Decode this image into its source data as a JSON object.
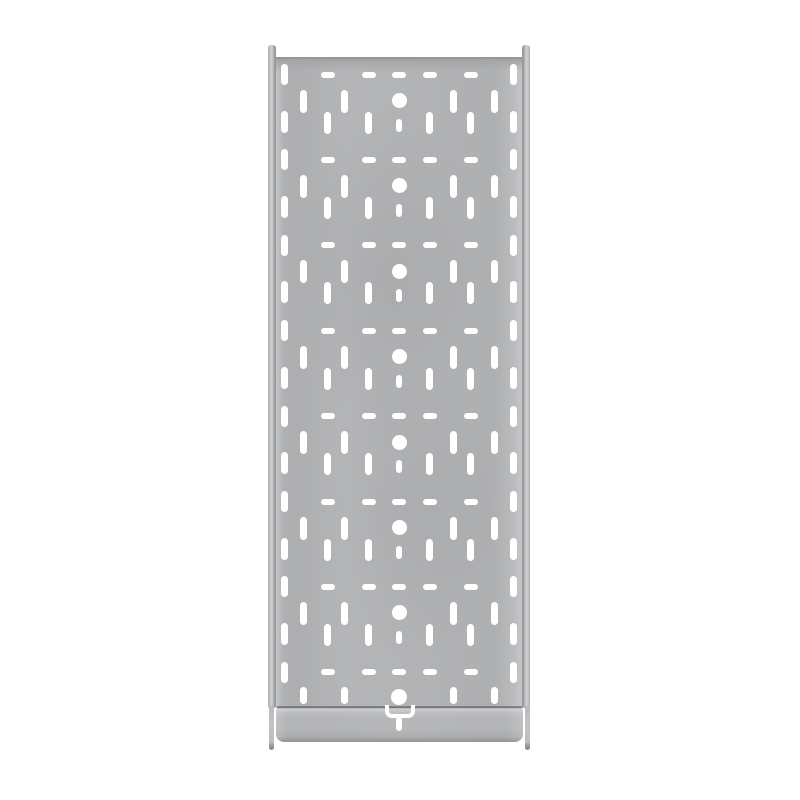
{
  "scene": {
    "type": "product-photo",
    "subject": "Perforated galvanized steel cable tray, straight section, base view",
    "background_color": "#ffffff",
    "visible_text": "none"
  },
  "colors": {
    "metal_base": "#b2b3b5",
    "metal_highlight": "#cbccce",
    "metal_shadow": "#909194",
    "top_edge_line": "#96979a",
    "seam_line": "#55575b",
    "perforation": "#ffffff"
  },
  "geometry": {
    "rail_left": {
      "x": 268,
      "y": 44.5,
      "w": 8,
      "h": 663.5
    },
    "rail_left_lower": {
      "x": 268.5,
      "y": 706,
      "w": 5,
      "h": 44
    },
    "rail_right": {
      "x": 522,
      "y": 44.5,
      "w": 8,
      "h": 663.5
    },
    "rail_right_lower": {
      "x": 524.5,
      "y": 706,
      "w": 5,
      "h": 44
    },
    "web": {
      "x": 276,
      "y": 57,
      "w": 246.5,
      "h": 651
    },
    "end_plate": {
      "x": 276,
      "y": 708.5,
      "w": 246.5,
      "h": 33.5
    },
    "seam": {
      "x": 276.5,
      "y": 706,
      "w": 245.5,
      "h": 2.5
    },
    "bracket": {
      "x": 384.5,
      "y": 705,
      "w": 30,
      "h": 12.5
    },
    "bracket_stem": {
      "x": 396.3,
      "y": 716.5,
      "w": 5.6,
      "h": 14
    }
  },
  "perforation_pattern": {
    "center_x": 399,
    "unit_pitch": 85.4,
    "unit_top_y": [
      74.5,
      159.9,
      245.3,
      330.7,
      416.1,
      501.5,
      586.9
    ],
    "last_unit_y": 672.3,
    "dash_slots": {
      "x_offsets": [
        -71.5,
        -30.5,
        0,
        30.5,
        71.5
      ],
      "w": 14,
      "h": 6,
      "dy": 0
    },
    "edge_slots": {
      "x_offsets": [
        -114.5,
        114.5
      ],
      "w": 7,
      "upper": {
        "dy": 0,
        "h": 21
      },
      "lower": {
        "dy": 47,
        "h": 22
      }
    },
    "high_slots": {
      "x_offsets": [
        -95.5,
        -54.5,
        54.5,
        95.5
      ],
      "w": 7,
      "h": 23,
      "dy": 26.5
    },
    "low_slots": {
      "x_offsets": [
        -71.5,
        -30.5,
        30.5,
        71.5
      ],
      "w": 7,
      "h": 22,
      "dy": 48
    },
    "center_hole": {
      "d": 15,
      "dy": 26
    },
    "center_slot": {
      "w": 6,
      "h": 13,
      "dy": 50.5
    },
    "last_unit": {
      "high_slots": {
        "h": 17,
        "dy": 23
      },
      "center_hole": {
        "d": 16,
        "dy": 24.2
      }
    }
  }
}
